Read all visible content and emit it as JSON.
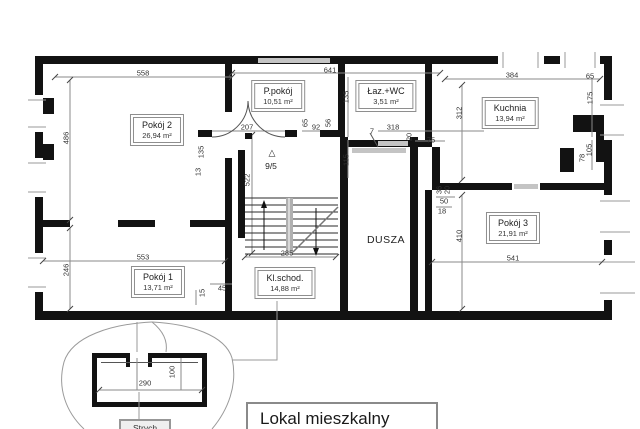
{
  "drawing": {
    "main_title": "Lokal mieszkalny",
    "inset_title": "Strych",
    "shaft_label": "DUSZA",
    "stair_symbol": "△",
    "stair_level": "9/5",
    "colors": {
      "wall": "#121212",
      "dim_line": "#8a8a8a",
      "dim_text": "#333333",
      "label_border": "#8e8e8e",
      "leader": "#9a9a9a",
      "opening_band": "#c4c4c4"
    },
    "rooms": [
      {
        "name": "Pokój 2",
        "area": "26,94 m²",
        "x": 157,
        "y": 130
      },
      {
        "name": "P.pokój",
        "area": "10,51 m²",
        "x": 278,
        "y": 96
      },
      {
        "name": "Łaz.+WC",
        "area": "3,51 m²",
        "x": 386,
        "y": 96
      },
      {
        "name": "Kuchnia",
        "area": "13,94 m²",
        "x": 510,
        "y": 113
      },
      {
        "name": "Pokój 1",
        "area": "13,71 m²",
        "x": 158,
        "y": 282
      },
      {
        "name": "Kl.schod.",
        "area": "14,88 m²",
        "x": 285,
        "y": 283
      },
      {
        "name": "Pokój 3",
        "area": "21,91 m²",
        "x": 513,
        "y": 228
      }
    ],
    "dim_labels": [
      {
        "t": "558",
        "x": 143,
        "y": 73
      },
      {
        "t": "641",
        "x": 330,
        "y": 70
      },
      {
        "t": "384",
        "x": 512,
        "y": 75
      },
      {
        "t": "65",
        "x": 590,
        "y": 76
      },
      {
        "t": "486",
        "x": 66,
        "y": 138,
        "r": 1
      },
      {
        "t": "246",
        "x": 66,
        "y": 270,
        "r": 1
      },
      {
        "t": "553",
        "x": 143,
        "y": 257
      },
      {
        "t": "285",
        "x": 287,
        "y": 253
      },
      {
        "t": "541",
        "x": 513,
        "y": 258
      },
      {
        "t": "522",
        "x": 247,
        "y": 180,
        "r": 1
      },
      {
        "t": "135",
        "x": 201,
        "y": 152,
        "r": 1
      },
      {
        "t": "13",
        "x": 198,
        "y": 172,
        "r": 1
      },
      {
        "t": "207",
        "x": 247,
        "y": 127
      },
      {
        "t": "65",
        "x": 305,
        "y": 123,
        "r": 1
      },
      {
        "t": "92",
        "x": 316,
        "y": 127
      },
      {
        "t": "56",
        "x": 328,
        "y": 123,
        "r": 1
      },
      {
        "t": "135",
        "x": 346,
        "y": 97,
        "r": 1
      },
      {
        "t": "115",
        "x": 346,
        "y": 160,
        "r": 1
      },
      {
        "t": "7",
        "x": 372,
        "y": 131
      },
      {
        "t": "318",
        "x": 393,
        "y": 127
      },
      {
        "t": "20",
        "x": 409,
        "y": 137,
        "r": 1
      },
      {
        "t": "75",
        "x": 431,
        "y": 140
      },
      {
        "t": "312",
        "x": 459,
        "y": 113,
        "r": 1
      },
      {
        "t": "50",
        "x": 444,
        "y": 201
      },
      {
        "t": "18",
        "x": 442,
        "y": 211
      },
      {
        "t": "36",
        "x": 439,
        "y": 190,
        "r": 1
      },
      {
        "t": "20",
        "x": 447,
        "y": 190,
        "r": 1
      },
      {
        "t": "410",
        "x": 459,
        "y": 236,
        "r": 1
      },
      {
        "t": "175",
        "x": 590,
        "y": 98,
        "r": 1
      },
      {
        "t": "105",
        "x": 589,
        "y": 150,
        "r": 1
      },
      {
        "t": "78",
        "x": 582,
        "y": 158,
        "r": 1
      },
      {
        "t": "15",
        "x": 202,
        "y": 293,
        "r": 1
      },
      {
        "t": "45",
        "x": 222,
        "y": 288
      },
      {
        "t": "290",
        "x": 145,
        "y": 383
      },
      {
        "t": "100",
        "x": 172,
        "y": 372,
        "r": 1
      }
    ]
  }
}
